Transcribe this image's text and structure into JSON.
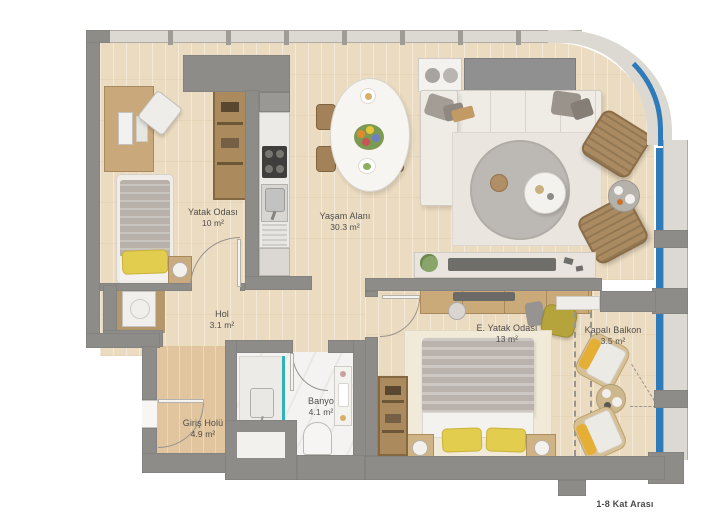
{
  "caption": "1-8 Kat Arası",
  "rooms": [
    {
      "name": "Yatak Odası",
      "area": "10 m²"
    },
    {
      "name": "Yaşam Alanı",
      "area": "30.3 m²"
    },
    {
      "name": "Hol",
      "area": "3.1 m²"
    },
    {
      "name": "Banyo",
      "area": "4.1 m²"
    },
    {
      "name": "Giriş Holü",
      "area": "4.9 m²"
    },
    {
      "name": "E. Yatak Odası",
      "area": "13 m²"
    },
    {
      "name": "Kapalı Balkon",
      "area": "3.5 m²"
    }
  ],
  "colors": {
    "wall": "#8d8c89",
    "wood_floor": "#ebdbc0",
    "entry_floor": "#e0c59f",
    "window_glass_blue": "#2f7ab8",
    "accent_pillow_yellow": "#e2cd4e",
    "accent_olive": "#b5a33b",
    "shower_glass_teal": "#2fb3b3"
  }
}
